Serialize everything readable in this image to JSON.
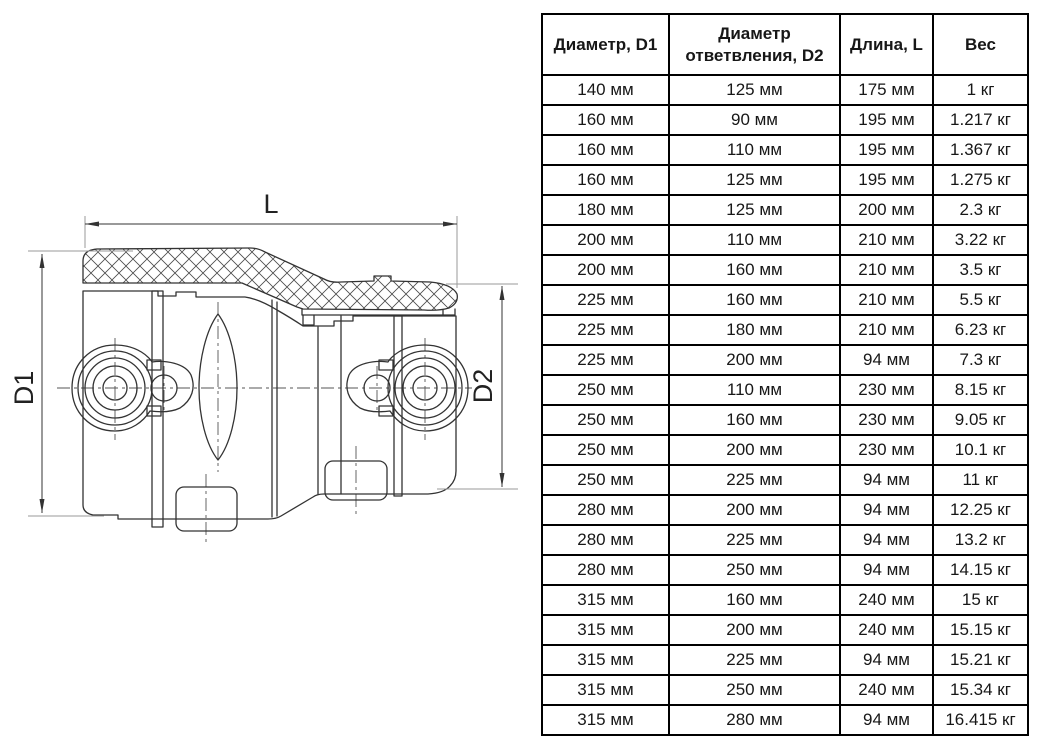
{
  "drawing": {
    "dim_length_label": "L",
    "dim_d1_label": "D1",
    "dim_d2_label": "D2"
  },
  "table": {
    "headers": [
      "Диаметр, D1",
      "Диаметр ответвления, D2",
      "Длина, L",
      "Вес"
    ],
    "rows": [
      [
        "140 мм",
        "125 мм",
        "175 мм",
        "1 кг"
      ],
      [
        "160 мм",
        "90 мм",
        "195 мм",
        "1.217 кг"
      ],
      [
        "160 мм",
        "110 мм",
        "195 мм",
        "1.367 кг"
      ],
      [
        "160 мм",
        "125 мм",
        "195 мм",
        "1.275 кг"
      ],
      [
        "180 мм",
        "125 мм",
        "200 мм",
        "2.3 кг"
      ],
      [
        "200 мм",
        "110 мм",
        "210 мм",
        "3.22 кг"
      ],
      [
        "200 мм",
        "160 мм",
        "210 мм",
        "3.5 кг"
      ],
      [
        "225 мм",
        "160 мм",
        "210 мм",
        "5.5 кг"
      ],
      [
        "225 мм",
        "180 мм",
        "210 мм",
        "6.23 кг"
      ],
      [
        "225 мм",
        "200 мм",
        "94 мм",
        "7.3 кг"
      ],
      [
        "250 мм",
        "110 мм",
        "230 мм",
        "8.15 кг"
      ],
      [
        "250 мм",
        "160 мм",
        "230 мм",
        "9.05 кг"
      ],
      [
        "250 мм",
        "200 мм",
        "230 мм",
        "10.1 кг"
      ],
      [
        "250 мм",
        "225 мм",
        "94 мм",
        "11 кг"
      ],
      [
        "280 мм",
        "200 мм",
        "94 мм",
        "12.25 кг"
      ],
      [
        "280 мм",
        "225 мм",
        "94 мм",
        "13.2 кг"
      ],
      [
        "280 мм",
        "250 мм",
        "94 мм",
        "14.15 кг"
      ],
      [
        "315 мм",
        "160 мм",
        "240 мм",
        "15 кг"
      ],
      [
        "315 мм",
        "200 мм",
        "240 мм",
        "15.15 кг"
      ],
      [
        "315 мм",
        "225 мм",
        "94 мм",
        "15.21 кг"
      ],
      [
        "315 мм",
        "250 мм",
        "240 мм",
        "15.34 кг"
      ],
      [
        "315 мм",
        "280 мм",
        "94 мм",
        "16.415 кг"
      ]
    ]
  },
  "colors": {
    "table_border": "#000000",
    "text": "#171717",
    "drawing_line": "#333333",
    "extension_line": "#9a9a9a"
  }
}
